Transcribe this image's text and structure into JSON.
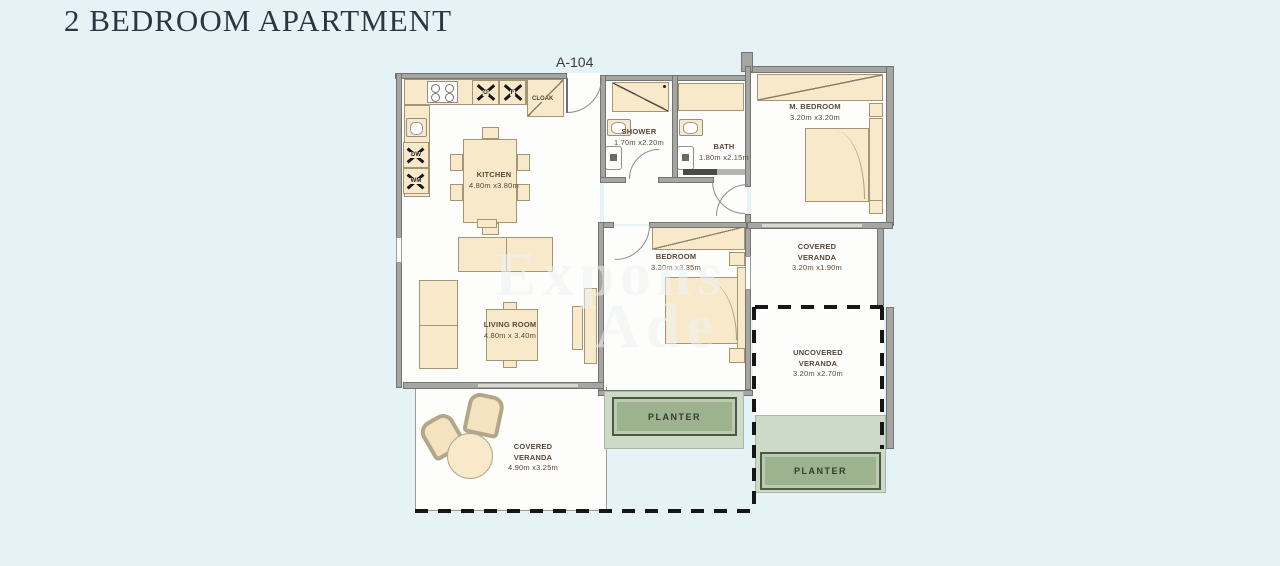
{
  "page": {
    "title": "2 BEDROOM APARTMENT",
    "unit": "A-104"
  },
  "rooms": {
    "kitchen": {
      "name": "KITCHEN",
      "dims": "4.80m x3.80m"
    },
    "living": {
      "name": "LIVING ROOM",
      "dims": "4.80m x 3.40m"
    },
    "master_bedroom": {
      "name": "M. BEDROOM",
      "dims": "3.20m x3.20m"
    },
    "bedroom": {
      "name": "BEDROOM",
      "dims": "3.30m x3.35m"
    },
    "shower": {
      "name": "SHOWER",
      "dims": "1.70m x2.20m"
    },
    "bath": {
      "name": "BATH",
      "dims": "1.80m x2.15m"
    },
    "covered_veranda_right": {
      "name": "COVERED VERANDA",
      "dims": "3.20m x1.90m"
    },
    "uncovered_veranda": {
      "name": "UNCOVERED VERANDA",
      "dims": "3.20m x2.70m"
    },
    "covered_veranda_bottom": {
      "name": "COVERED VERANDA",
      "dims": "4.90m x3.25m"
    }
  },
  "markers": {
    "cloak": "CLOAK",
    "oven": "O",
    "fridge": "F",
    "dishwasher": "DW",
    "washing_machine": "WM"
  },
  "planters": {
    "planter1": "PLANTER",
    "planter2": "PLANTER"
  },
  "watermark": {
    "line1": "Expons",
    "line2": "Ade"
  },
  "colors": {
    "background": "#e6f3f6",
    "wall": "#a5a5a1",
    "furniture": "#f8e9cb",
    "planter": "#9db28f",
    "planter_light": "#ccdac7",
    "label_text": "#584838",
    "title_text": "#2c3640"
  }
}
